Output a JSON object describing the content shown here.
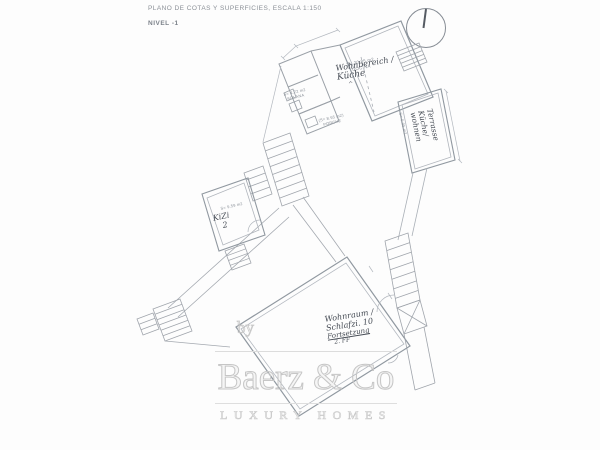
{
  "document": {
    "title": "PLANO DE COTAS Y SUPERFICIES, ESCALA 1:150",
    "level": "NIVEL -1"
  },
  "plan": {
    "labels": {
      "cocina": {
        "area": "S= 20.85 m2",
        "name": "COCINA"
      },
      "solana": {
        "area": "S= 4.72 m2",
        "name": "SOLANA"
      },
      "porche": {
        "area": "(S= 8.95 m2)",
        "name": "PORCHE"
      },
      "room_959": {
        "area": "S= 9.59 m2"
      },
      "terrace_595": {
        "area": "S= 5.95 m2"
      }
    },
    "notes": {
      "upper_room": {
        "line1": "Wohnbereich /",
        "line2": "Küche",
        "line3": "^"
      },
      "terrace": {
        "line1": "Terrasse",
        "line2": "Küche/",
        "line3": "wohnen"
      },
      "left_room": {
        "line1": "KiZi",
        "line2": "2"
      },
      "lower_room": {
        "line1": "Wohnraum /",
        "line2": "Schlafzi. 10",
        "line3": "Fortsetzung",
        "line4": "2. FF"
      }
    }
  },
  "watermark": {
    "prefix": "by",
    "brand": "Baerz & Co",
    "tagline": "LUXURY HOMES"
  },
  "icons": {
    "north_indicator": "north-circle-icon"
  },
  "colors": {
    "plan_line": "#a6abb2",
    "wall_line": "#9098a0",
    "handwriting": "#454b54",
    "print_label": "#8a9098",
    "watermark": "#c6c6c6",
    "title_text": "#8b9097"
  }
}
